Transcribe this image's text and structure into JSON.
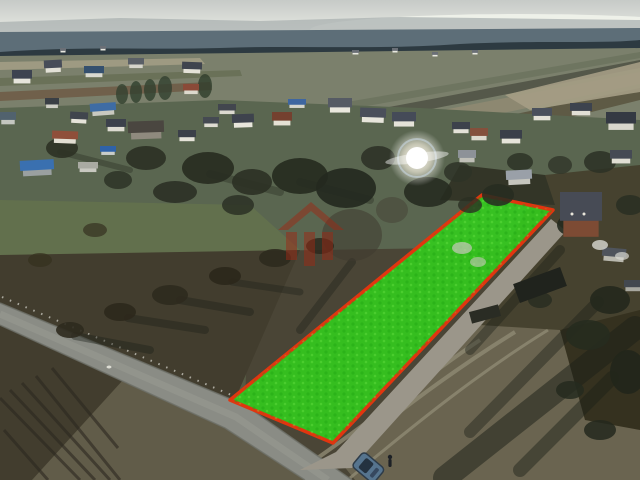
{
  "scene": {
    "kind": "aerial-drone-photograph",
    "subject": "rural village with building parcel highlighted in green with red boundary"
  },
  "colors": {
    "sky_top": "#c6cac7",
    "sky_horizon": "#eef0e9",
    "hills": "#a6aeae",
    "distant_band": "#5d6e78",
    "treeline": "#2d3a41",
    "far_fields": "#7b806c",
    "mud_strip": "#a59d85",
    "village_green": "#5a6650",
    "pasture": "#62704d",
    "scrub_field": "#565a44",
    "dark_field": "#423d2e",
    "light_strip": "#615c49",
    "rough_field": "#6a6450",
    "yard_dark": "#46422f",
    "yard_shadow": "#35311f",
    "grove_dark": "#333527",
    "road": "#8a8c85",
    "road_edge": "#6e7069",
    "gravel": "#9b968a",
    "track": "#8f8a74",
    "shadow": "#1c2018",
    "plot_green": "#33cb1d",
    "plot_red": "#e1350f",
    "watermark_red": "#9c2a16",
    "flare_white": "#ffffff",
    "car_body": "#56748e",
    "car_glass": "#243240"
  },
  "plot": {
    "points": "482,195 553,210 333,443 230,400",
    "fill": "#33cb1d",
    "fill_opacity": "0.9",
    "stroke": "#e1350f",
    "stroke_width": "3.5"
  },
  "watermark": {
    "icon": "house-logo-watermark",
    "color": "#9c2a16",
    "opacity": "0.5"
  },
  "flare": {
    "cx": "417",
    "cy": "158"
  },
  "houses": [
    {
      "x": 12,
      "y": 70,
      "w": 20,
      "h": 12,
      "roof": "#3d4350",
      "wall": "#e7e5dc",
      "a": 0
    },
    {
      "x": 44,
      "y": 60,
      "w": 18,
      "h": 11,
      "roof": "#474c58",
      "wall": "#e2e0d6",
      "a": -3
    },
    {
      "x": 84,
      "y": 66,
      "w": 20,
      "h": 10,
      "roof": "#35506e",
      "wall": "#d9d9d0",
      "a": 0
    },
    {
      "x": 128,
      "y": 58,
      "w": 16,
      "h": 9,
      "roof": "#5a5f66",
      "wall": "#d6d5cb",
      "a": 0
    },
    {
      "x": 182,
      "y": 62,
      "w": 20,
      "h": 10,
      "roof": "#3f444e",
      "wall": "#e4e2d8",
      "a": 2
    },
    {
      "x": 183,
      "y": 84,
      "w": 16,
      "h": 9,
      "roof": "#8a4a38",
      "wall": "#ddd9cd",
      "a": 0
    },
    {
      "x": 90,
      "y": 103,
      "w": 26,
      "h": 11,
      "roof": "#3e6ca4",
      "wall": "#c9c9c0",
      "a": -4
    },
    {
      "x": 0,
      "y": 112,
      "w": 16,
      "h": 11,
      "roof": "#51626e",
      "wall": "#c4c6c0",
      "a": 0
    },
    {
      "x": 45,
      "y": 98,
      "w": 14,
      "h": 9,
      "roof": "#3a3f45",
      "wall": "#cfcfc6",
      "a": 0
    },
    {
      "x": 218,
      "y": 104,
      "w": 18,
      "h": 9,
      "roof": "#42464e",
      "wall": "#dcdad0",
      "a": 0
    },
    {
      "x": 70,
      "y": 112,
      "w": 18,
      "h": 10,
      "roof": "#40454d",
      "wall": "#e6e4da",
      "a": 3
    },
    {
      "x": 106,
      "y": 119,
      "w": 20,
      "h": 11,
      "roof": "#3c414b",
      "wall": "#dddbd1",
      "a": 0
    },
    {
      "x": 52,
      "y": 131,
      "w": 26,
      "h": 11,
      "roof": "#8f4f3a",
      "wall": "#e2ded2",
      "a": 2
    },
    {
      "x": 128,
      "y": 121,
      "w": 36,
      "h": 16,
      "roof": "#4a4640",
      "wall": "#8f8a7e",
      "a": -2
    },
    {
      "x": 178,
      "y": 130,
      "w": 18,
      "h": 10,
      "roof": "#3b4049",
      "wall": "#e5e3d9",
      "a": 0
    },
    {
      "x": 203,
      "y": 117,
      "w": 16,
      "h": 9,
      "roof": "#454a52",
      "wall": "#dedcd2",
      "a": 0
    },
    {
      "x": 232,
      "y": 114,
      "w": 22,
      "h": 12,
      "roof": "#3e434d",
      "wall": "#e8e6dc",
      "a": -2
    },
    {
      "x": 272,
      "y": 112,
      "w": 20,
      "h": 12,
      "roof": "#74402f",
      "wall": "#e5e1d5",
      "a": 0
    },
    {
      "x": 288,
      "y": 99,
      "w": 18,
      "h": 8,
      "roof": "#3e66a0",
      "wall": "#d5d5cc",
      "a": 0
    },
    {
      "x": 100,
      "y": 146,
      "w": 16,
      "h": 8,
      "roof": "#2f62a8",
      "wall": "#c9cdc9",
      "a": 0
    },
    {
      "x": 20,
      "y": 160,
      "w": 34,
      "h": 14,
      "roof": "#3a70b0",
      "wall": "#9aa0a0",
      "a": -3
    },
    {
      "x": 78,
      "y": 162,
      "w": 20,
      "h": 9,
      "roof": "#a9aaa2",
      "wall": "#c8c8c0",
      "a": 0
    },
    {
      "x": 328,
      "y": 98,
      "w": 24,
      "h": 13,
      "roof": "#565b64",
      "wall": "#e9e7dd",
      "a": 0
    },
    {
      "x": 360,
      "y": 108,
      "w": 26,
      "h": 13,
      "roof": "#4a4f5a",
      "wall": "#e7e5db",
      "a": 2
    },
    {
      "x": 392,
      "y": 112,
      "w": 24,
      "h": 13,
      "roof": "#454b58",
      "wall": "#e5e3d9",
      "a": 0
    },
    {
      "x": 452,
      "y": 122,
      "w": 18,
      "h": 10,
      "roof": "#3d424c",
      "wall": "#e4e2d8",
      "a": 0
    },
    {
      "x": 470,
      "y": 128,
      "w": 18,
      "h": 11,
      "roof": "#84503c",
      "wall": "#ddd9cd",
      "a": 0
    },
    {
      "x": 500,
      "y": 130,
      "w": 22,
      "h": 12,
      "roof": "#3a3f49",
      "wall": "#e6e4da",
      "a": 0
    },
    {
      "x": 532,
      "y": 108,
      "w": 20,
      "h": 11,
      "roof": "#4a505c",
      "wall": "#e3e1d7",
      "a": 0
    },
    {
      "x": 570,
      "y": 103,
      "w": 22,
      "h": 11,
      "roof": "#3d434e",
      "wall": "#e2e0d6",
      "a": 0
    },
    {
      "x": 606,
      "y": 112,
      "w": 30,
      "h": 16,
      "roof": "#343943",
      "wall": "#d8d6cc",
      "a": 0
    },
    {
      "x": 458,
      "y": 150,
      "w": 18,
      "h": 11,
      "roof": "#8d9298",
      "wall": "#c0c0b8",
      "a": 0
    },
    {
      "x": 506,
      "y": 170,
      "w": 26,
      "h": 13,
      "roof": "#9aa0a8",
      "wall": "#c6c6be",
      "a": -3
    },
    {
      "x": 560,
      "y": 192,
      "w": 42,
      "h": 40,
      "roof": "#474b55",
      "wall": "#7d4b34",
      "a": 0
    },
    {
      "x": 610,
      "y": 150,
      "w": 22,
      "h": 12,
      "roof": "#454a54",
      "wall": "#e0ded4",
      "a": 0
    },
    {
      "x": 602,
      "y": 248,
      "w": 24,
      "h": 12,
      "roof": "#4f545c",
      "wall": "#b9b8ae",
      "a": 5
    },
    {
      "x": 624,
      "y": 280,
      "w": 18,
      "h": 10,
      "roof": "#43484f",
      "wall": "#a8a8a0",
      "a": 0
    },
    {
      "x": 352,
      "y": 50,
      "w": 7,
      "h": 4,
      "roof": "#6a6f76",
      "wall": "#e8e8e0",
      "a": 0
    },
    {
      "x": 392,
      "y": 48,
      "w": 6,
      "h": 4,
      "roof": "#6a6f76",
      "wall": "#e8e8e0",
      "a": 0
    },
    {
      "x": 432,
      "y": 52,
      "w": 6,
      "h": 4,
      "roof": "#6a6f76",
      "wall": "#e8e8e0",
      "a": 0
    },
    {
      "x": 472,
      "y": 50,
      "w": 6,
      "h": 4,
      "roof": "#6a6f76",
      "wall": "#e8e8e0",
      "a": 0
    },
    {
      "x": 60,
      "y": 48,
      "w": 6,
      "h": 4,
      "roof": "#6a6f76",
      "wall": "#e8e8e0",
      "a": 0
    },
    {
      "x": 100,
      "y": 46,
      "w": 6,
      "h": 4,
      "roof": "#6a6f76",
      "wall": "#e8e8e0",
      "a": 0
    }
  ],
  "trees": [
    {
      "cx": 62,
      "cy": 148,
      "rx": 16,
      "ry": 10,
      "f": "#2c3124",
      "o": 0.9
    },
    {
      "cx": 146,
      "cy": 158,
      "rx": 20,
      "ry": 12,
      "f": "#2b3023",
      "o": 0.9
    },
    {
      "cx": 208,
      "cy": 168,
      "rx": 26,
      "ry": 16,
      "f": "#282d21",
      "o": 0.92
    },
    {
      "cx": 252,
      "cy": 182,
      "rx": 20,
      "ry": 13,
      "f": "#2b3024",
      "o": 0.9
    },
    {
      "cx": 300,
      "cy": 176,
      "rx": 28,
      "ry": 18,
      "f": "#262b1f",
      "o": 0.92
    },
    {
      "cx": 346,
      "cy": 188,
      "rx": 30,
      "ry": 20,
      "f": "#242920",
      "o": 0.92
    },
    {
      "cx": 378,
      "cy": 158,
      "rx": 17,
      "ry": 12,
      "f": "#2c3126",
      "o": 0.88
    },
    {
      "cx": 428,
      "cy": 192,
      "rx": 24,
      "ry": 15,
      "f": "#262b20",
      "o": 0.9
    },
    {
      "cx": 458,
      "cy": 172,
      "rx": 14,
      "ry": 10,
      "f": "#2e3327",
      "o": 0.85
    },
    {
      "cx": 520,
      "cy": 162,
      "rx": 13,
      "ry": 9,
      "f": "#2d3226",
      "o": 0.85
    },
    {
      "cx": 498,
      "cy": 195,
      "rx": 16,
      "ry": 11,
      "f": "#272c21",
      "o": 0.88
    },
    {
      "cx": 560,
      "cy": 165,
      "rx": 12,
      "ry": 9,
      "f": "#2f3428",
      "o": 0.8
    },
    {
      "cx": 600,
      "cy": 162,
      "rx": 16,
      "ry": 11,
      "f": "#2b3024",
      "o": 0.85
    },
    {
      "cx": 630,
      "cy": 205,
      "rx": 14,
      "ry": 10,
      "f": "#292e22",
      "o": 0.85
    },
    {
      "cx": 572,
      "cy": 225,
      "rx": 15,
      "ry": 11,
      "f": "#252a1f",
      "o": 0.9
    },
    {
      "cx": 610,
      "cy": 300,
      "rx": 20,
      "ry": 14,
      "f": "#23281d",
      "o": 0.9
    },
    {
      "cx": 588,
      "cy": 335,
      "rx": 22,
      "ry": 15,
      "f": "#262b1f",
      "o": 0.88
    },
    {
      "cx": 628,
      "cy": 372,
      "rx": 18,
      "ry": 22,
      "f": "#21261b",
      "o": 0.9
    },
    {
      "cx": 352,
      "cy": 235,
      "rx": 30,
      "ry": 26,
      "f": "#3f3b2f",
      "o": 0.55
    },
    {
      "cx": 392,
      "cy": 210,
      "rx": 16,
      "ry": 13,
      "f": "#433f33",
      "o": 0.5
    },
    {
      "cx": 175,
      "cy": 192,
      "rx": 22,
      "ry": 11,
      "f": "#2a2f23",
      "o": 0.88
    },
    {
      "cx": 118,
      "cy": 180,
      "rx": 14,
      "ry": 9,
      "f": "#2d3226",
      "o": 0.85
    },
    {
      "cx": 238,
      "cy": 205,
      "rx": 16,
      "ry": 10,
      "f": "#2b3024",
      "o": 0.85
    },
    {
      "cx": 165,
      "cy": 88,
      "rx": 7,
      "ry": 12,
      "f": "#32402f",
      "o": 0.8
    },
    {
      "cx": 150,
      "cy": 90,
      "rx": 6,
      "ry": 11,
      "f": "#31402e",
      "o": 0.8
    },
    {
      "cx": 136,
      "cy": 92,
      "rx": 6,
      "ry": 11,
      "f": "#31402e",
      "o": 0.8
    },
    {
      "cx": 122,
      "cy": 94,
      "rx": 6,
      "ry": 10,
      "f": "#33412f",
      "o": 0.8
    },
    {
      "cx": 205,
      "cy": 86,
      "rx": 7,
      "ry": 12,
      "f": "#2f3d2c",
      "o": 0.8
    },
    {
      "cx": 70,
      "cy": 330,
      "rx": 14,
      "ry": 8,
      "f": "#2e2a1e",
      "o": 0.9
    },
    {
      "cx": 120,
      "cy": 312,
      "rx": 16,
      "ry": 9,
      "f": "#2c281c",
      "o": 0.9
    },
    {
      "cx": 170,
      "cy": 295,
      "rx": 18,
      "ry": 10,
      "f": "#2e2a1e",
      "o": 0.9
    },
    {
      "cx": 225,
      "cy": 276,
      "rx": 16,
      "ry": 9,
      "f": "#2b271b",
      "o": 0.9
    },
    {
      "cx": 275,
      "cy": 258,
      "rx": 16,
      "ry": 9,
      "f": "#2e2a1e",
      "o": 0.9
    },
    {
      "cx": 320,
      "cy": 246,
      "rx": 14,
      "ry": 8,
      "f": "#2c281c",
      "o": 0.85
    },
    {
      "cx": 95,
      "cy": 230,
      "rx": 12,
      "ry": 7,
      "f": "#35311f",
      "o": 0.7
    },
    {
      "cx": 40,
      "cy": 260,
      "rx": 12,
      "ry": 7,
      "f": "#34301e",
      "o": 0.7
    },
    {
      "cx": 600,
      "cy": 430,
      "rx": 16,
      "ry": 10,
      "f": "#23281d",
      "o": 0.85
    },
    {
      "cx": 570,
      "cy": 390,
      "rx": 14,
      "ry": 9,
      "f": "#252a1f",
      "o": 0.85
    },
    {
      "cx": 540,
      "cy": 300,
      "rx": 12,
      "ry": 8,
      "f": "#272c20",
      "o": 0.8
    },
    {
      "cx": 470,
      "cy": 205,
      "rx": 12,
      "ry": 8,
      "f": "#2a2f23",
      "o": 0.8
    }
  ],
  "shadow_streaks": [
    {
      "x1": 635,
      "y1": 328,
      "x2": 445,
      "y2": 478,
      "w": 24,
      "o": 0.5
    },
    {
      "x1": 598,
      "y1": 302,
      "x2": 470,
      "y2": 432,
      "w": 12,
      "o": 0.42
    },
    {
      "x1": 560,
      "y1": 250,
      "x2": 470,
      "y2": 350,
      "w": 10,
      "o": 0.4
    },
    {
      "x1": 352,
      "y1": 262,
      "x2": 300,
      "y2": 330,
      "w": 8,
      "o": 0.35
    },
    {
      "x1": 75,
      "y1": 336,
      "x2": 150,
      "y2": 350,
      "w": 8,
      "o": 0.4
    },
    {
      "x1": 128,
      "y1": 318,
      "x2": 205,
      "y2": 330,
      "w": 8,
      "o": 0.38
    },
    {
      "x1": 180,
      "y1": 300,
      "x2": 250,
      "y2": 312,
      "w": 8,
      "o": 0.38
    },
    {
      "x1": 232,
      "y1": 282,
      "x2": 300,
      "y2": 292,
      "w": 7,
      "o": 0.35
    },
    {
      "x1": 612,
      "y1": 378,
      "x2": 520,
      "y2": 470,
      "w": 14,
      "o": 0.45
    },
    {
      "x1": 60,
      "y1": 152,
      "x2": 130,
      "y2": 170,
      "w": 6,
      "o": 0.3
    },
    {
      "x1": 300,
      "y1": 182,
      "x2": 370,
      "y2": 200,
      "w": 8,
      "o": 0.3
    },
    {
      "x1": 210,
      "y1": 174,
      "x2": 280,
      "y2": 192,
      "w": 8,
      "o": 0.3
    }
  ]
}
